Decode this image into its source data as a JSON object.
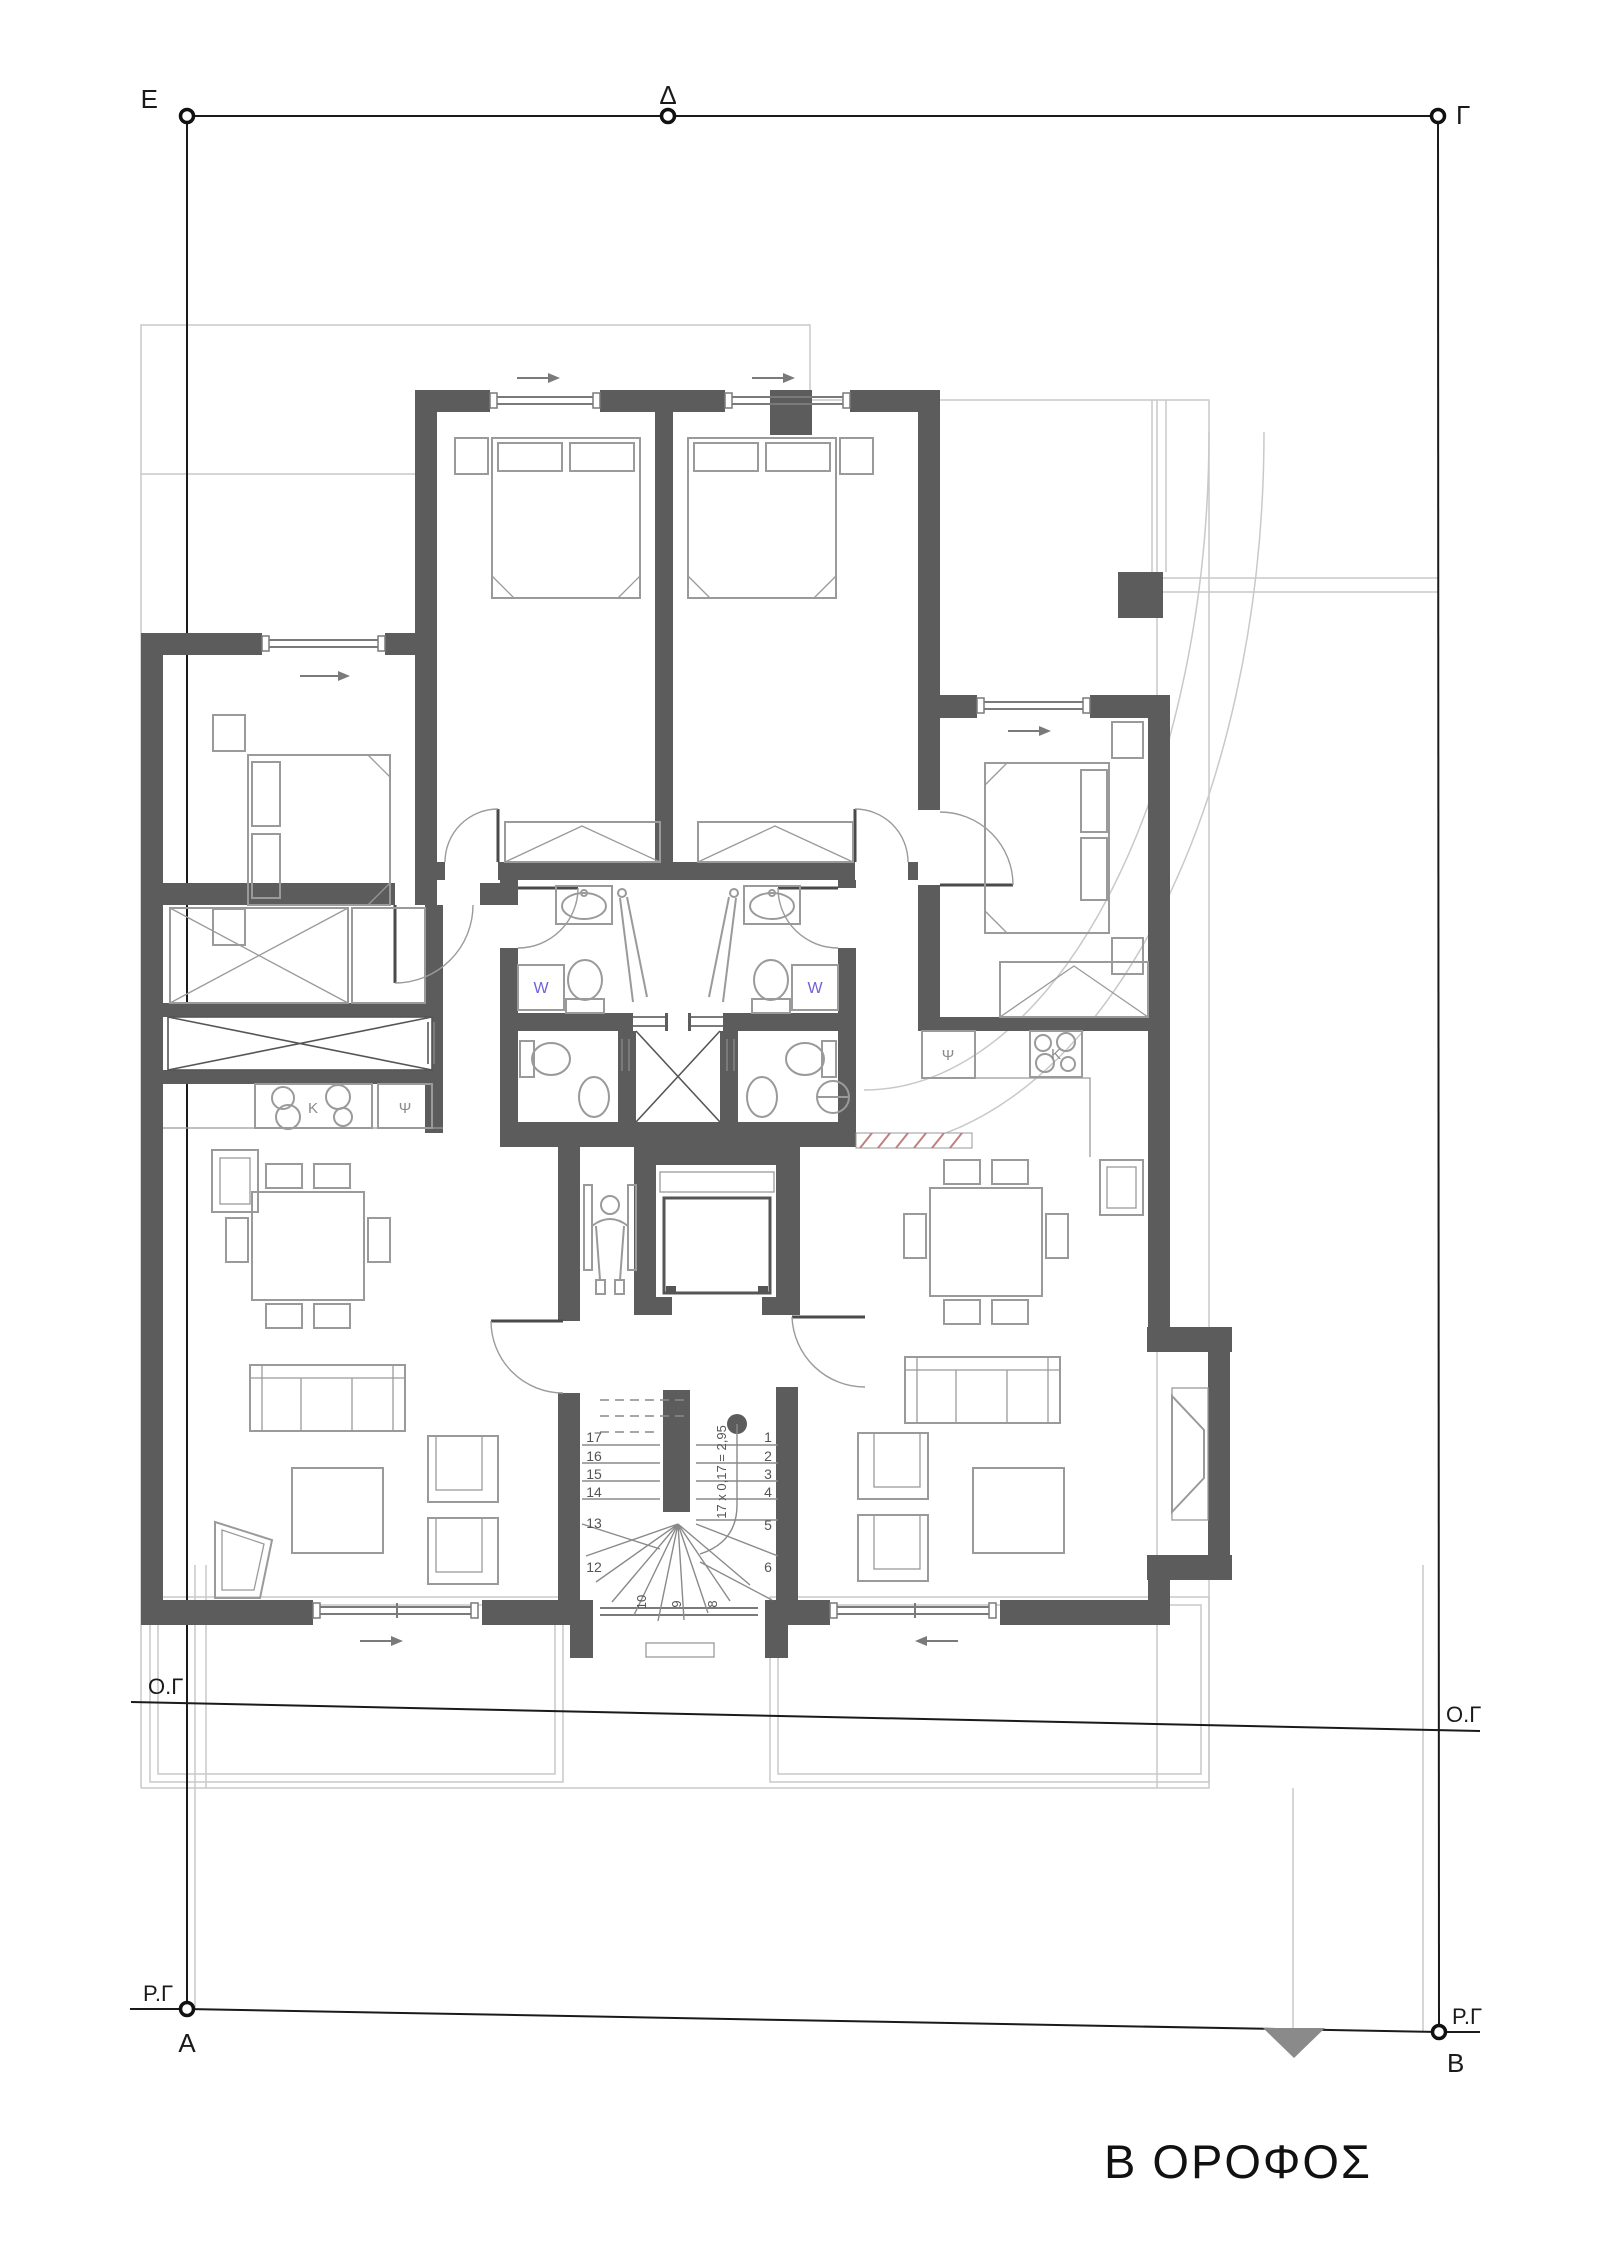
{
  "title": "Β ΟΡΟΦΟΣ",
  "survey": {
    "markers": {
      "top_left": "Ε",
      "top_mid": "Δ",
      "top_right": "Γ",
      "bottom_left": "Α",
      "bottom_right": "Β"
    },
    "building_line_label": "Ο.Γ",
    "street_line_label": "Ρ.Γ"
  },
  "stairs": {
    "formula": "17 x 0,17 = 2,95",
    "right_steps": [
      "1",
      "2",
      "3",
      "4",
      "5",
      "6"
    ],
    "left_steps": [
      "17",
      "16",
      "15",
      "14",
      "13",
      "12"
    ],
    "bottom_steps": [
      "10",
      "9",
      "8"
    ]
  },
  "appliances": {
    "washer": "W",
    "fridge": "Ψ",
    "stove": "Κ"
  },
  "colors": {
    "wall": "#5c5c5c",
    "survey": "#1a1a1a",
    "furniture": "#9a9a9a",
    "guide": "#c9c9c9",
    "washer_label": "#6f61d9",
    "accent_hatch": "#c08080"
  }
}
